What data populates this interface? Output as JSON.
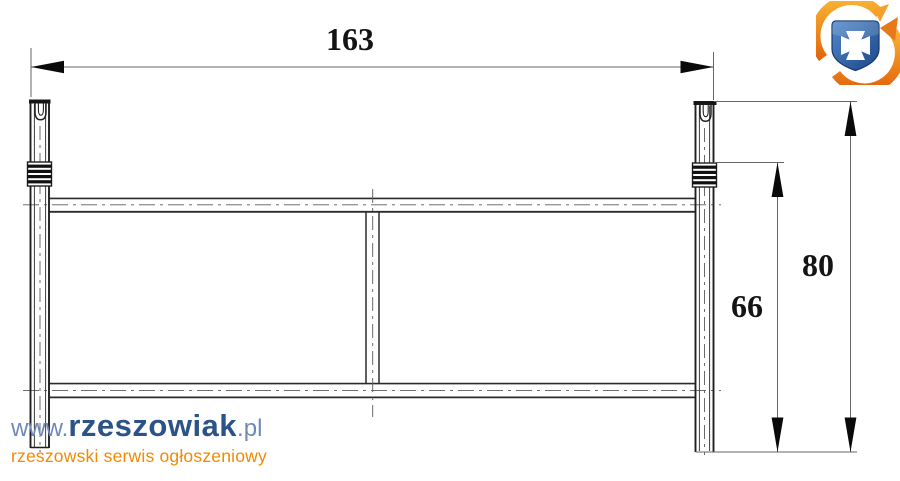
{
  "drawing": {
    "dim_width": "163",
    "dim_height_total": "80",
    "dim_height_collar": "66"
  },
  "watermark": {
    "prefix": "www.",
    "brand": "rzeszowiak",
    "suffix": ".pl",
    "tagline": "rzeszowski serwis ogłoszeniowy"
  },
  "logo": {
    "icon": "rzeszow-crest-circular-arrows-logo"
  },
  "colors": {
    "drawing_line": "#2b2b2b",
    "thin_line": "#555555",
    "dimension_line": "#666666",
    "arrowhead": "#0a0a0a",
    "watermark_blue_light": "#7089b8",
    "watermark_blue_dark": "#2b5389",
    "watermark_orange": "#f18a00",
    "logo_blue_dark": "#1b4787",
    "logo_blue_light": "#4f84c7",
    "logo_orange": "#f0861c"
  }
}
